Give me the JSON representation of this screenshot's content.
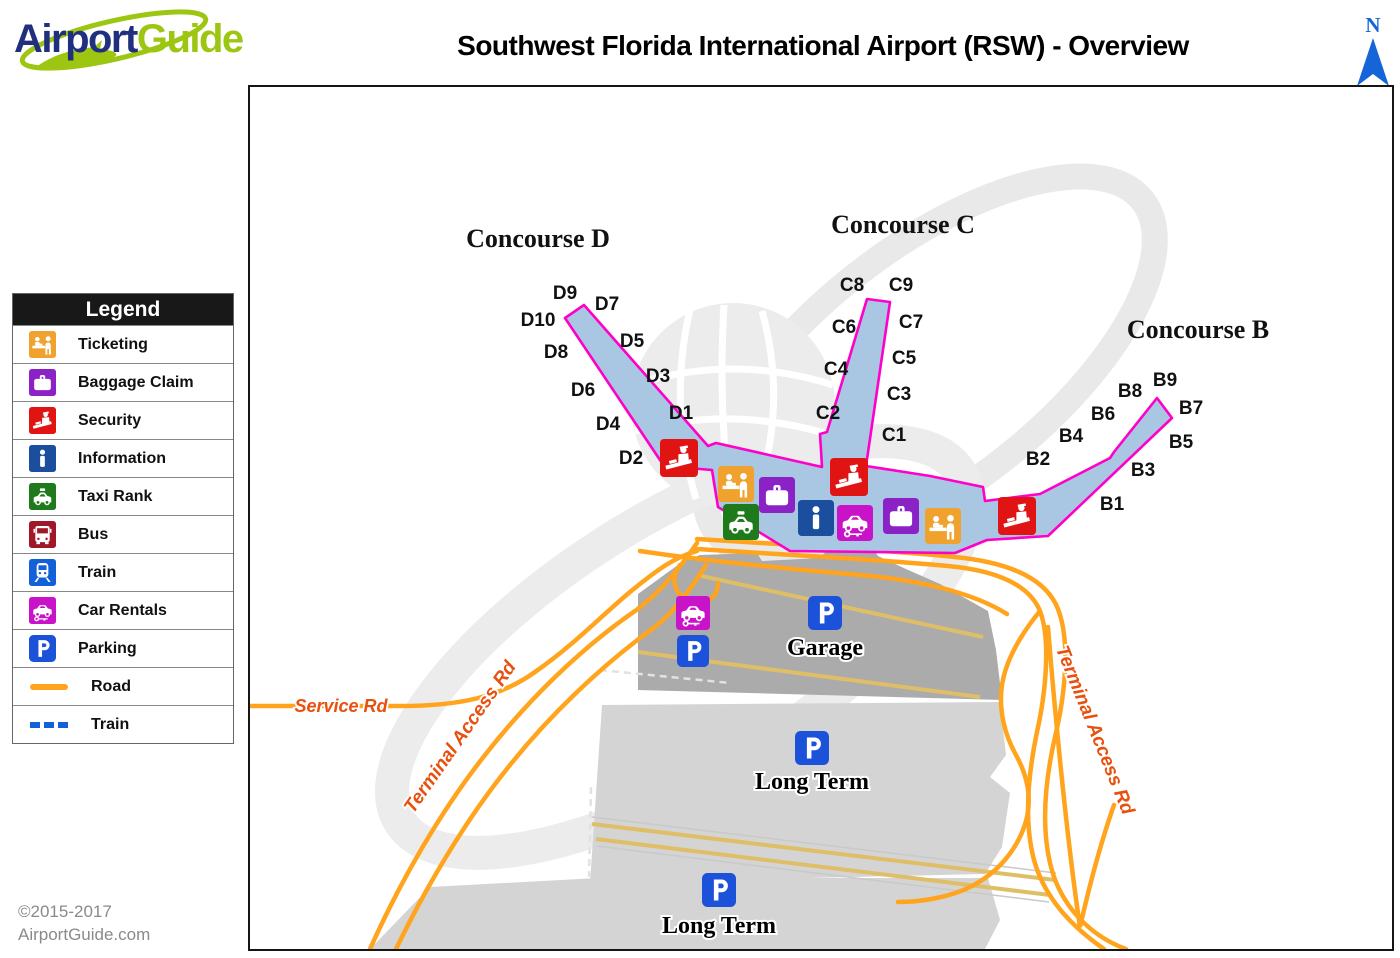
{
  "logo": {
    "airport": "Airport",
    "guide": "Guide"
  },
  "title": "Southwest Florida International Airport (RSW) - Overview",
  "north": {
    "label": "N"
  },
  "legend": {
    "header": "Legend",
    "items": [
      {
        "icon": "ticketing-icon",
        "label": "Ticketing"
      },
      {
        "icon": "baggage-claim-icon",
        "label": "Baggage Claim"
      },
      {
        "icon": "security-icon",
        "label": "Security"
      },
      {
        "icon": "information-icon",
        "label": "Information"
      },
      {
        "icon": "taxi-rank-icon",
        "label": "Taxi Rank"
      },
      {
        "icon": "bus-icon",
        "label": "Bus"
      },
      {
        "icon": "train-icon",
        "label": "Train"
      },
      {
        "icon": "car-rentals-icon",
        "label": "Car Rentals"
      },
      {
        "icon": "parking-icon",
        "label": "Parking"
      },
      {
        "icon": "road-line",
        "label": "Road"
      },
      {
        "icon": "train-dashed-line",
        "label": "Train"
      }
    ]
  },
  "map": {
    "concourses": {
      "d": "Concourse D",
      "c": "Concourse C",
      "b": "Concourse B"
    },
    "gates": {
      "d": [
        "D9",
        "D7",
        "D10",
        "D5",
        "D8",
        "D3",
        "D6",
        "D1",
        "D4",
        "D2"
      ],
      "c": [
        "C8",
        "C9",
        "C6",
        "C7",
        "C5",
        "C4",
        "C3",
        "C2",
        "C1"
      ],
      "b": [
        "B9",
        "B8",
        "B7",
        "B6",
        "B5",
        "B4",
        "B3",
        "B2",
        "B1"
      ]
    },
    "roads": {
      "service": "Service Rd",
      "terminal_access": "Terminal Access Rd"
    },
    "areas": {
      "garage": "Garage",
      "long_term": "Long Term"
    }
  },
  "copyright": {
    "line1": "©2015-2017",
    "line2": "AirportGuide.com"
  },
  "colors": {
    "terminal_outline": "#FF00C8",
    "terminal_fill": "#A9C6E3",
    "road_orange": "#FFA41C",
    "road_label": "#E8500F",
    "north_arrow": "#1565D8",
    "logo_navy": "#20307E",
    "logo_green": "#9DC613",
    "garage_gray": "#ABABAB",
    "lot_gray": "#D4D4D4"
  }
}
